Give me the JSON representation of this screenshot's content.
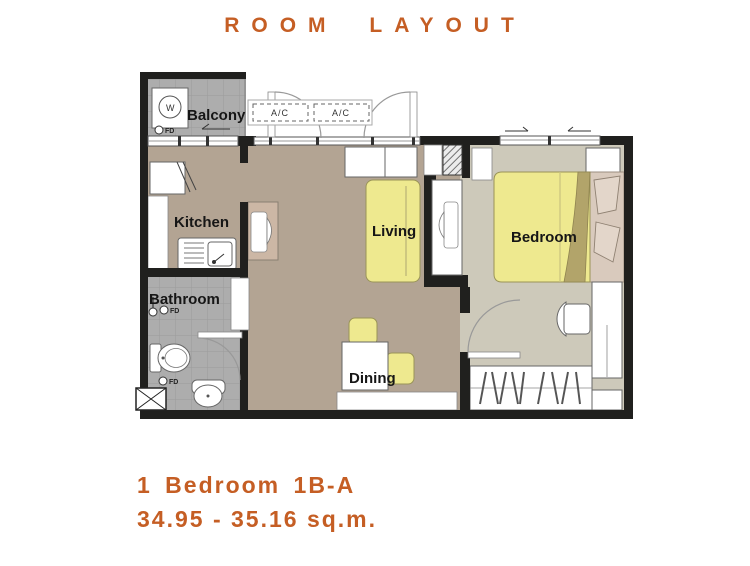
{
  "title": "ROOM LAYOUT",
  "footer": {
    "line1": "1 Bedroom 1B-A",
    "line2": "34.95 - 35.16 sq.m."
  },
  "rooms": {
    "balcony": "Balcony",
    "kitchen": "Kitchen",
    "bathroom": "Bathroom",
    "living": "Living",
    "dining": "Dining",
    "bedroom": "Bedroom"
  },
  "labels": {
    "ac1": "A/C",
    "ac2": "A/C",
    "washer": "W",
    "fd_balcony": "FD",
    "fd_bathroom_upper": "FD",
    "fd_bathroom_lower": "FD"
  },
  "colors": {
    "accent": "#c55e24",
    "wall": "#20201e",
    "floor_main": "#b3a493",
    "floor_bedroom": "#cdc9ba",
    "floor_wet_tile": "#adadad",
    "furniture_yellow": "#eee98f",
    "cabinet_tan": "#ccb7a5",
    "bedding_pink": "#d9cabd"
  }
}
